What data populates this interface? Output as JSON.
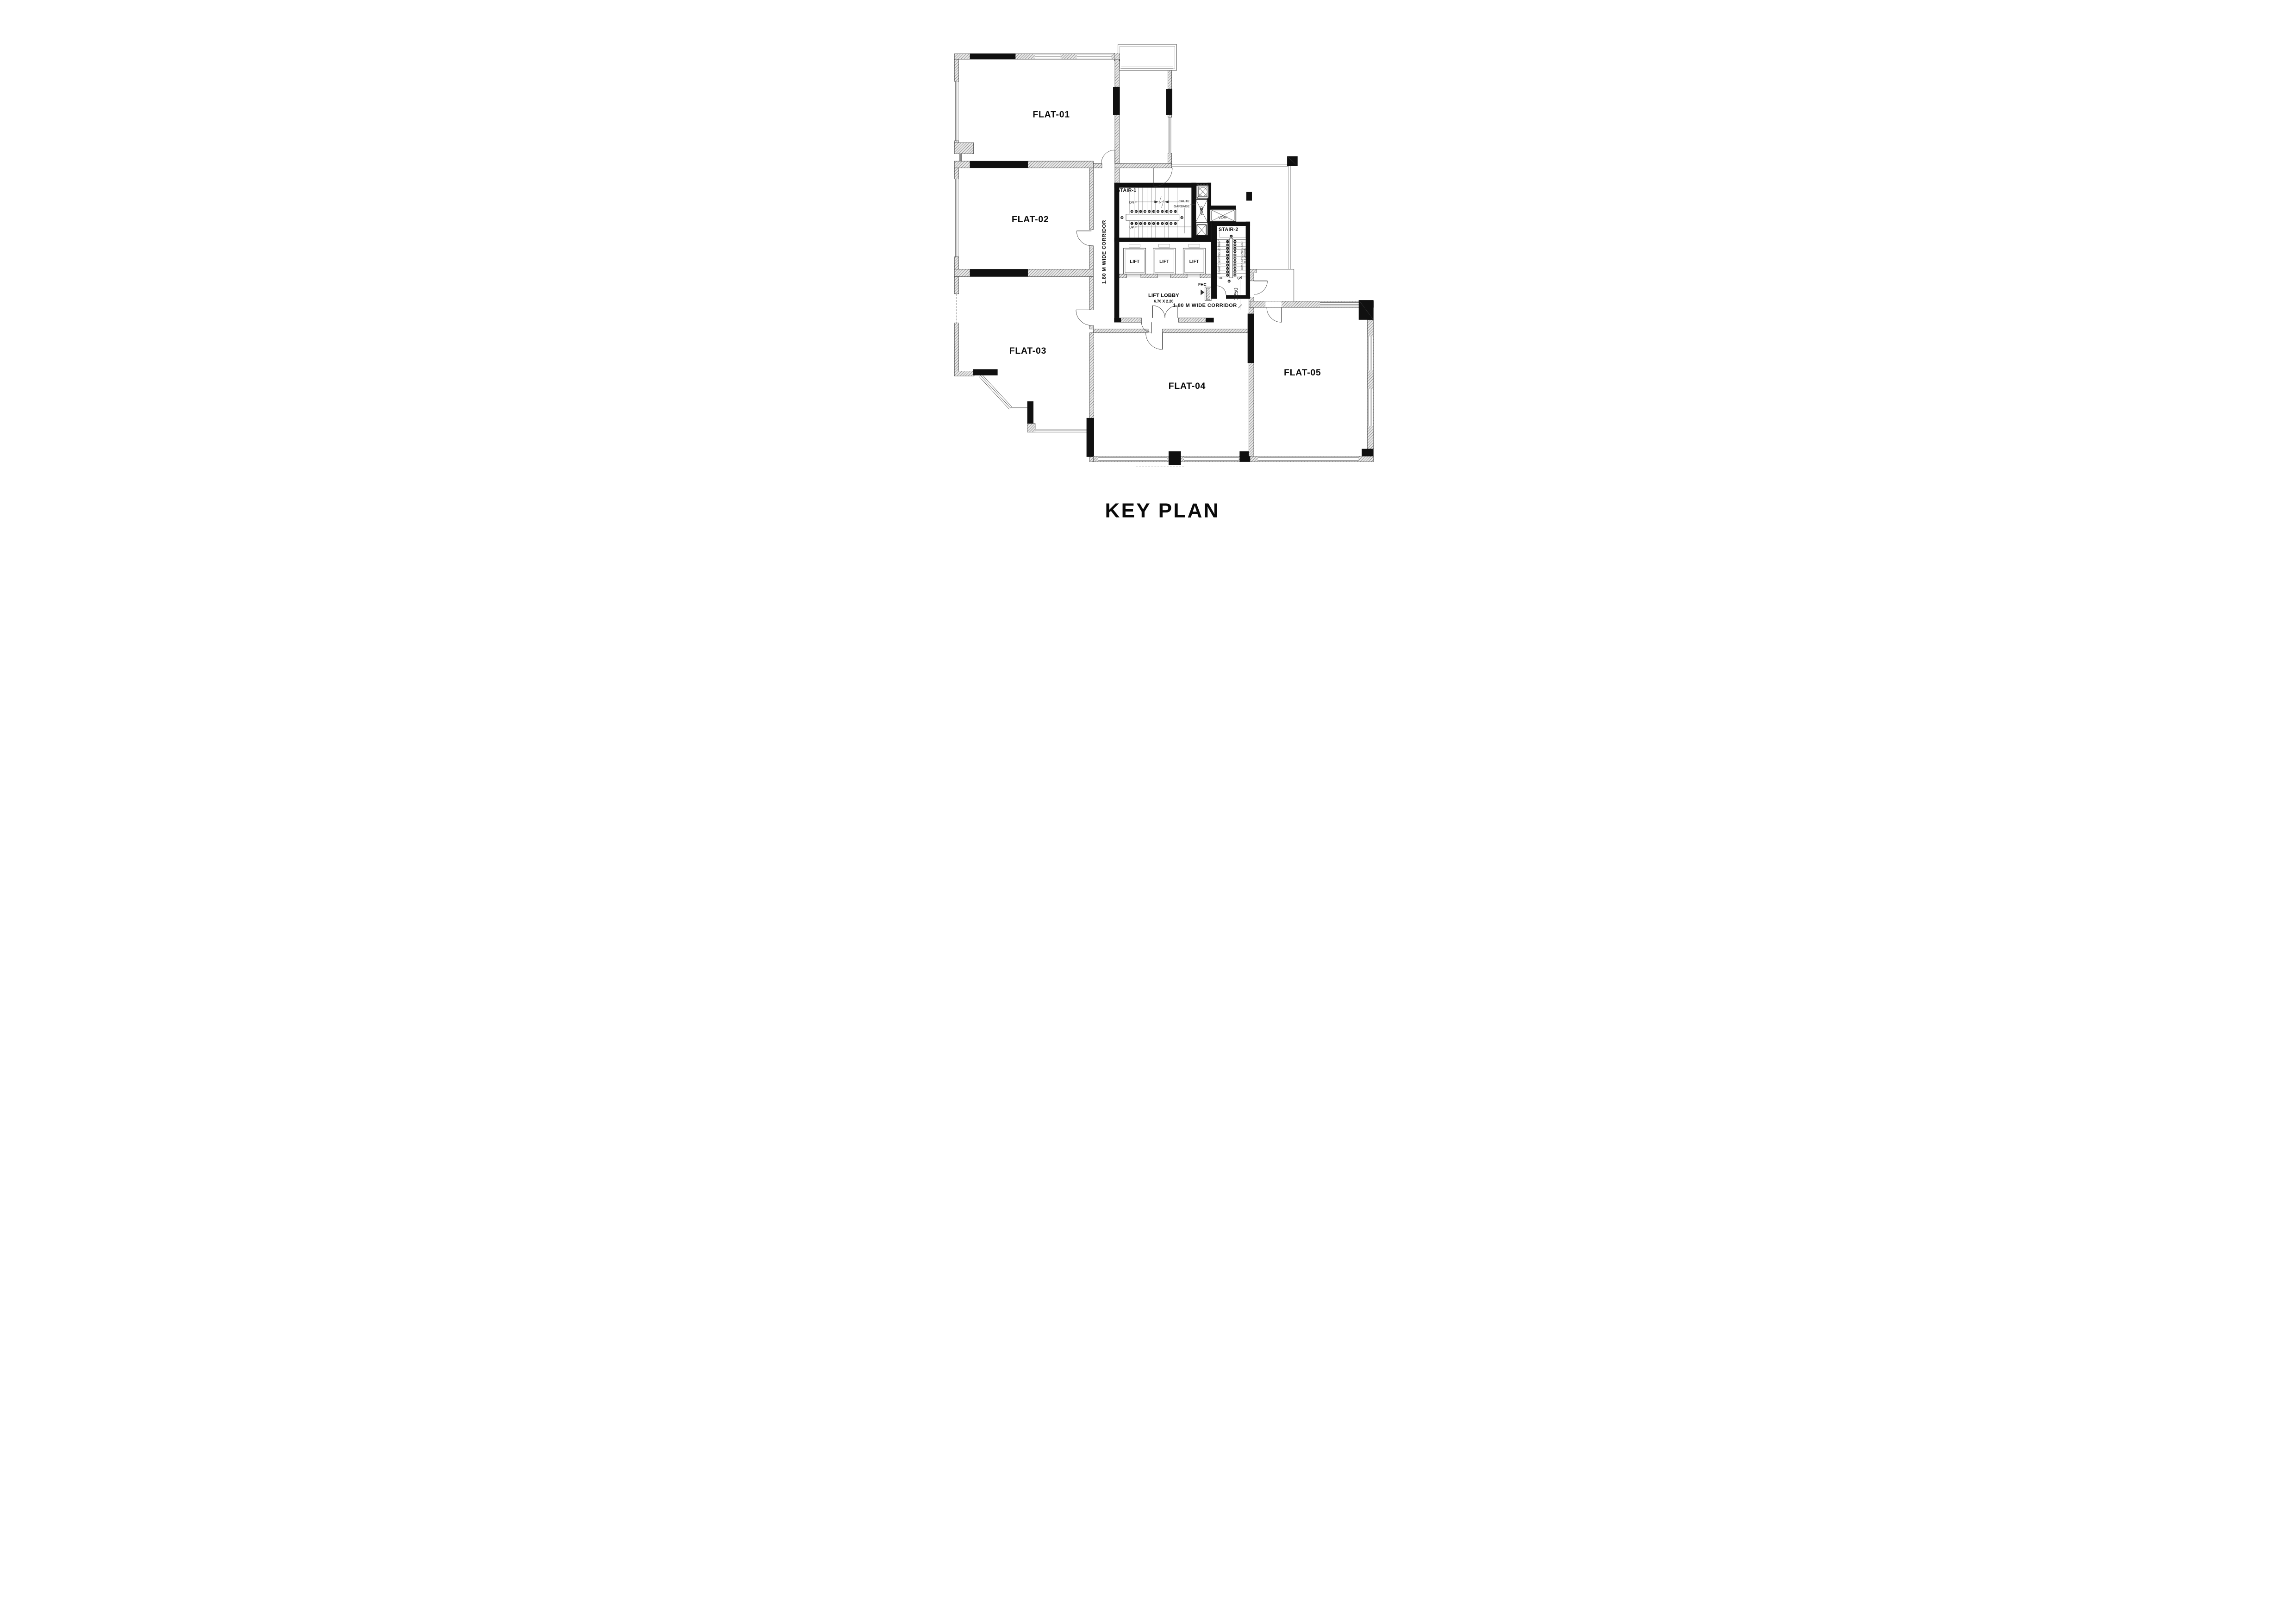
{
  "title": "KEY PLAN",
  "flats": {
    "f1": "FLAT-01",
    "f2": "FLAT-02",
    "f3": "FLAT-03",
    "f4": "FLAT-04",
    "f5": "FLAT-05"
  },
  "corridors": {
    "vertical": "1.80 M WIDE CORRIDOR",
    "horizontal": "1.80 M WIDE CORRIDOR"
  },
  "core": {
    "stair1": {
      "label": "STAIR-1",
      "dn": "DN",
      "up": "UP",
      "treads_down": [
        "23",
        "22",
        "21",
        "20",
        "19",
        "18",
        "17",
        "16",
        "15",
        "14",
        "13"
      ],
      "treads_up": [
        "1",
        "2",
        "3",
        "4",
        "5",
        "6",
        "7",
        "8",
        "9",
        "10",
        "11"
      ],
      "landing_left": "24",
      "landing_right": "12"
    },
    "chute": {
      "line1": "CHUTE",
      "line2": "GARBAGE"
    },
    "void_vertical": "VOID",
    "void_horizontal": "VOID",
    "lifts": [
      "LIFT",
      "LIFT",
      "LIFT"
    ],
    "lobby": {
      "label": "LIFT LOBBY",
      "size": "6.70 X 2.20"
    },
    "fhc": "FHC",
    "stair2": {
      "label": "STAIR-2",
      "up": "UP",
      "dn": "DN",
      "dim": "1250",
      "treads_up": [
        "1",
        "2",
        "3",
        "4",
        "5",
        "6",
        "7",
        "8",
        "9",
        "10",
        "11"
      ],
      "treads_down": [
        "13",
        "14",
        "15",
        "16",
        "17",
        "18",
        "19",
        "20",
        "21",
        "22",
        "23"
      ],
      "top_num": "12",
      "bottom_num": "24",
      "note_left": "GRANITE SKIRTING 100 MM HT",
      "note_right1": "1030 X 300 GRANITE STEP",
      "note_right2": "W 3 GROOVE"
    }
  }
}
